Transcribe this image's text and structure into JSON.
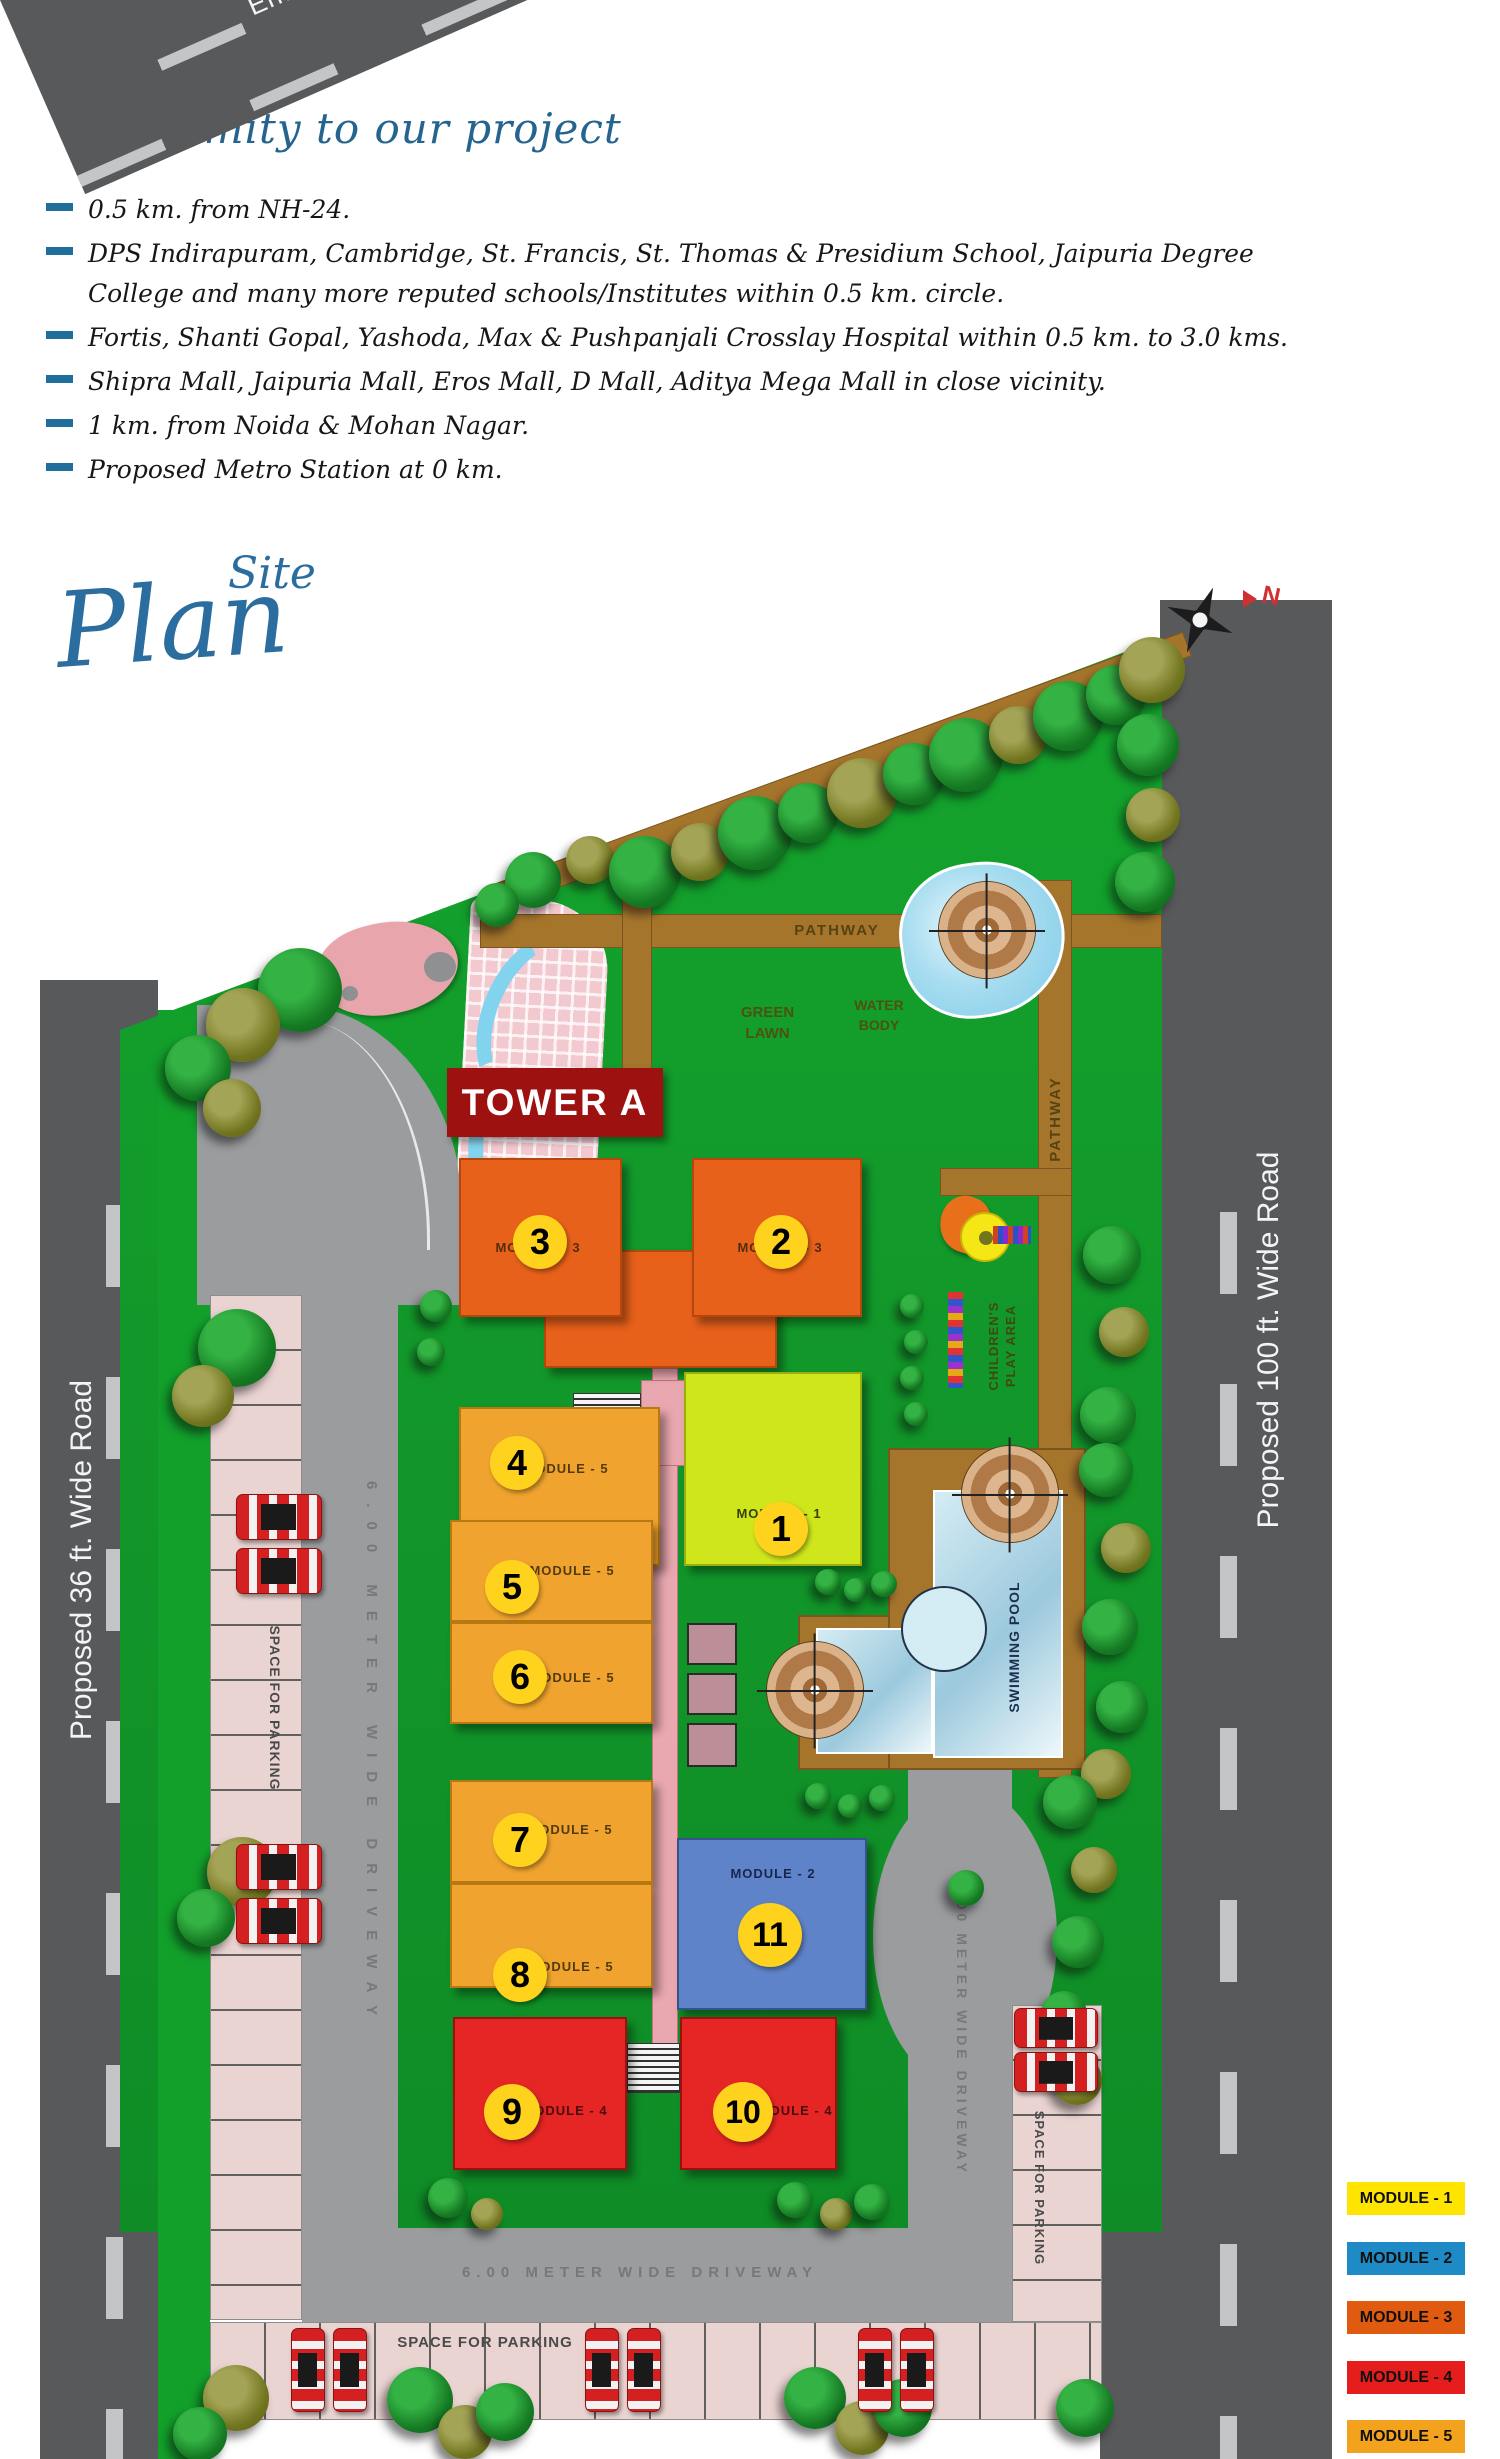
{
  "proximity": {
    "title": "Proximity to our project",
    "items": [
      "0.5 km. from NH-24.",
      "DPS Indirapuram, Cambridge, St. Francis, St. Thomas & Presidium School, Jaipuria Degree College and many more reputed schools/Institutes within 0.5 km. circle.",
      "Fortis, Shanti Gopal, Yashoda, Max & Pushpanjali Crosslay Hospital within 0.5 km. to 3.0 kms.",
      "Shipra Mall, Jaipuria Mall, Eros Mall, D Mall, Aditya Mega Mall in close vicinity.",
      "1 km. from Noida & Mohan Nagar.",
      "Proposed Metro Station at 0 km."
    ]
  },
  "site_plan": {
    "logo_site": "Site",
    "logo_plan": "Plan",
    "tower_banner": "TOWER A",
    "compass_n": "N",
    "roads": {
      "top": "150 ft. Wide Road",
      "left": "Proposed 36 ft. Wide Road",
      "right": "Proposed 100 ft. Wide Road",
      "entry": "Entry/Exit",
      "driveway": "6.00 METER WIDE DRIVEWAY"
    },
    "areas": {
      "pathway": "PATHWAY",
      "green_lawn": "GREEN LAWN",
      "water_body": "WATER BODY",
      "swimming_pool": "SWIMMING POOL",
      "children_play_area": "CHILDREN'S PLAY AREA",
      "parking": "SPACE FOR PARKING"
    },
    "modules": [
      {
        "num": "3",
        "label": "MODULE - 3"
      },
      {
        "num": "2",
        "label": "MODULE - 3"
      },
      {
        "num": "4",
        "label": "MODULE - 5"
      },
      {
        "num": "1",
        "label": "MODULE - 1"
      },
      {
        "num": "5",
        "label": "MODULE - 5"
      },
      {
        "num": "6",
        "label": "MODULE - 5"
      },
      {
        "num": "7",
        "label": "MODULE - 5"
      },
      {
        "num": "8",
        "label": "MODULE - 5"
      },
      {
        "num": "11",
        "label": "MODULE - 2"
      },
      {
        "num": "9",
        "label": "MODULE - 4"
      },
      {
        "num": "10",
        "label": "MODULE - 4"
      }
    ],
    "legend": [
      {
        "label": "MODULE - 1",
        "color": "#ffe400"
      },
      {
        "label": "MODULE - 2",
        "color": "#1e8bc6"
      },
      {
        "label": "MODULE - 3",
        "color": "#e05a10"
      },
      {
        "label": "MODULE - 4",
        "color": "#e51d1d"
      },
      {
        "label": "MODULE - 5",
        "color": "#f2a21c"
      }
    ]
  }
}
